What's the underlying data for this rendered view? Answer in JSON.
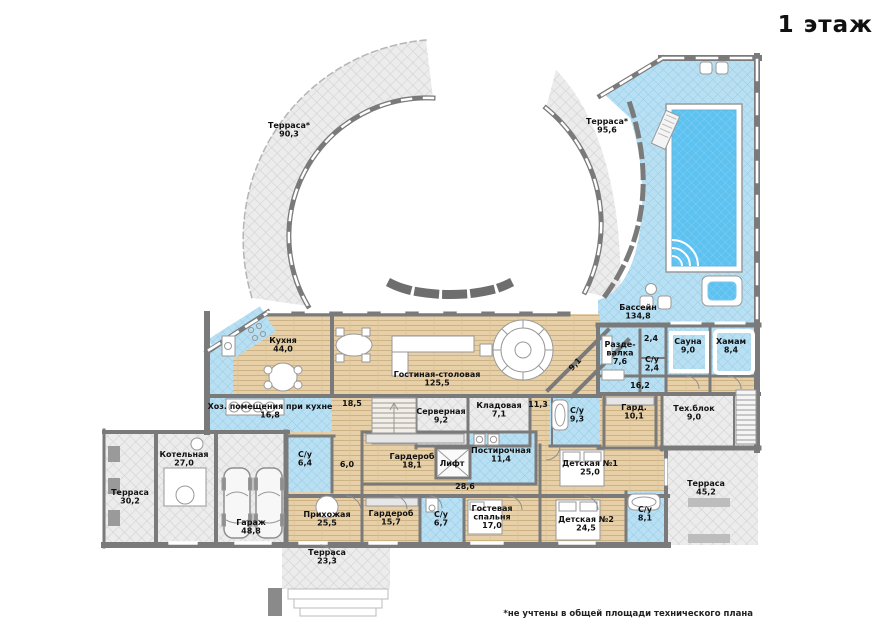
{
  "title": "1 этаж",
  "footnote": "*не учтены в общей площади технического плана",
  "colors": {
    "wall": "#7a7a7a",
    "wood_floor": "#e7d0a8",
    "tile_floor": "#b9e0f2",
    "terrace_floor": "#ececec",
    "pool_water": "#5ec2f0"
  },
  "rooms": [
    {
      "id": "terrace-top-left",
      "lines": [
        "Терраса*",
        "90,3"
      ],
      "x": 289,
      "y": 128
    },
    {
      "id": "terrace-top-right",
      "lines": [
        "Терраса*",
        "95,6"
      ],
      "x": 607,
      "y": 124
    },
    {
      "id": "pool-hall",
      "lines": [
        "Бассейн",
        "134,8"
      ],
      "x": 638,
      "y": 310
    },
    {
      "id": "kitchen",
      "lines": [
        "Кухня",
        "44,0"
      ],
      "x": 283,
      "y": 343
    },
    {
      "id": "living-dining",
      "lines": [
        "Гостиная-столовая",
        "125,5"
      ],
      "x": 437,
      "y": 377
    },
    {
      "id": "hall-9-1",
      "lines": [
        "9,1"
      ],
      "x": 577,
      "y": 366,
      "rot": -47
    },
    {
      "id": "changing-room",
      "lines": [
        "Разде-",
        "валка",
        "7,6"
      ],
      "x": 620,
      "y": 347
    },
    {
      "id": "room-2-4",
      "lines": [
        "2,4"
      ],
      "x": 651,
      "y": 341
    },
    {
      "id": "wc-2-4",
      "lines": [
        "С/у",
        "2,4"
      ],
      "x": 652,
      "y": 362
    },
    {
      "id": "sauna",
      "lines": [
        "Сауна",
        "9,0"
      ],
      "x": 688,
      "y": 344
    },
    {
      "id": "hammam",
      "lines": [
        "Хамам",
        "8,4"
      ],
      "x": 731,
      "y": 344
    },
    {
      "id": "hall-16-2",
      "lines": [
        "16,2"
      ],
      "x": 640,
      "y": 388
    },
    {
      "id": "kitchen-utility",
      "lines": [
        "Хоз. помещения при кухне",
        "16,8"
      ],
      "x": 270,
      "y": 409
    },
    {
      "id": "hall-18-5",
      "lines": [
        "18,5"
      ],
      "x": 352,
      "y": 406
    },
    {
      "id": "server-room",
      "lines": [
        "Серверная",
        "9,2"
      ],
      "x": 441,
      "y": 414
    },
    {
      "id": "storage",
      "lines": [
        "Кладовая",
        "7,1"
      ],
      "x": 499,
      "y": 408
    },
    {
      "id": "hall-11-3",
      "lines": [
        "11,3"
      ],
      "x": 538,
      "y": 407
    },
    {
      "id": "wc-9-3",
      "lines": [
        "С/у",
        "9,3"
      ],
      "x": 577,
      "y": 413
    },
    {
      "id": "wardrobe-10-1",
      "lines": [
        "Гард.",
        "10,1"
      ],
      "x": 634,
      "y": 410
    },
    {
      "id": "tech-block",
      "lines": [
        "Тех.блок",
        "9,0"
      ],
      "x": 694,
      "y": 411
    },
    {
      "id": "wc-6-4",
      "lines": [
        "С/у",
        "6,4"
      ],
      "x": 305,
      "y": 457
    },
    {
      "id": "hall-6-0",
      "lines": [
        "6,0"
      ],
      "x": 347,
      "y": 467
    },
    {
      "id": "wardrobe-18-1",
      "lines": [
        "Гардероб",
        "18,1"
      ],
      "x": 412,
      "y": 459
    },
    {
      "id": "elevator",
      "lines": [
        "Лифт"
      ],
      "x": 452,
      "y": 466
    },
    {
      "id": "laundry",
      "lines": [
        "Постирочная",
        "11,4"
      ],
      "x": 501,
      "y": 453
    },
    {
      "id": "hall-28-6",
      "lines": [
        "28,6"
      ],
      "x": 465,
      "y": 489
    },
    {
      "id": "kidsroom-1",
      "lines": [
        "Детская №1",
        "25,0"
      ],
      "x": 590,
      "y": 466
    },
    {
      "id": "boiler-room",
      "lines": [
        "Котельная",
        "27,0"
      ],
      "x": 184,
      "y": 457
    },
    {
      "id": "terrace-30-2",
      "lines": [
        "Терраса",
        "30,2"
      ],
      "x": 130,
      "y": 495
    },
    {
      "id": "garage",
      "lines": [
        "Гараж",
        "48,8"
      ],
      "x": 251,
      "y": 525
    },
    {
      "id": "entry-hall",
      "lines": [
        "Прихожая",
        "25,5"
      ],
      "x": 327,
      "y": 517
    },
    {
      "id": "wardrobe-15-7",
      "lines": [
        "Гардероб",
        "15,7"
      ],
      "x": 391,
      "y": 516
    },
    {
      "id": "wc-6-7",
      "lines": [
        "С/у",
        "6,7"
      ],
      "x": 441,
      "y": 517
    },
    {
      "id": "guest-bedroom",
      "lines": [
        "Гостевая",
        "спальня",
        "17,0"
      ],
      "x": 492,
      "y": 511
    },
    {
      "id": "kidsroom-2",
      "lines": [
        "Детская №2",
        "24,5"
      ],
      "x": 586,
      "y": 522
    },
    {
      "id": "wc-8-1",
      "lines": [
        "С/у",
        "8,1"
      ],
      "x": 645,
      "y": 512
    },
    {
      "id": "terrace-45-2",
      "lines": [
        "Терраса",
        "45,2"
      ],
      "x": 706,
      "y": 486
    },
    {
      "id": "terrace-23-3",
      "lines": [
        "Терраса",
        "23,3"
      ],
      "x": 327,
      "y": 555
    }
  ]
}
